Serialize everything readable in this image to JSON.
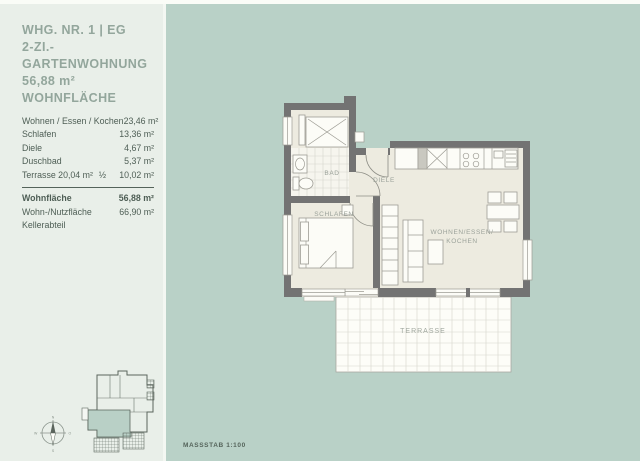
{
  "colors": {
    "background_green": "#b9d1c7",
    "panel_light": "#e9efe9",
    "wall_gray": "#737373",
    "floor_beige": "#edebe0",
    "highlight_unit_green": "#b9d0c6",
    "text_primary": "#4e5e55",
    "text_header": "#93a69c"
  },
  "header": {
    "line1": "WHG. NR. 1 | EG",
    "line2": "2-ZI.- GARTENWOHNUNG",
    "line3": "56,88 m² WOHNFLÄCHE"
  },
  "area_table": {
    "rows": [
      {
        "label": "Wohnen / Essen / Kochen",
        "fraction": "",
        "value": "23,46 m²"
      },
      {
        "label": "Schlafen",
        "fraction": "",
        "value": "13,36 m²"
      },
      {
        "label": "Diele",
        "fraction": "",
        "value": "4,67 m²"
      },
      {
        "label": "Duschbad",
        "fraction": "",
        "value": "5,37 m²"
      },
      {
        "label": "Terrasse 20,04 m²",
        "fraction": "½",
        "value": "10,02 m²"
      }
    ],
    "summary": [
      {
        "label": "Wohnfläche",
        "value": "56,88 m²"
      },
      {
        "label": "Wohn-/Nutzfläche",
        "value": "66,90 m²"
      },
      {
        "label": "Kellerabteil",
        "value": ""
      }
    ]
  },
  "plan": {
    "labels": {
      "bad": "BAD",
      "diele": "DIELE",
      "schlafen": "SCHLAFEN",
      "wohnen_line1": "WOHNEN/ESSEN/",
      "wohnen_line2": "KOCHEN",
      "terrasse": "TERRASSE"
    }
  },
  "compass": {
    "n": "N",
    "o": "O",
    "s": "S",
    "w": "W"
  },
  "footer": {
    "scale_label": "MASSSTAB 1:100"
  }
}
